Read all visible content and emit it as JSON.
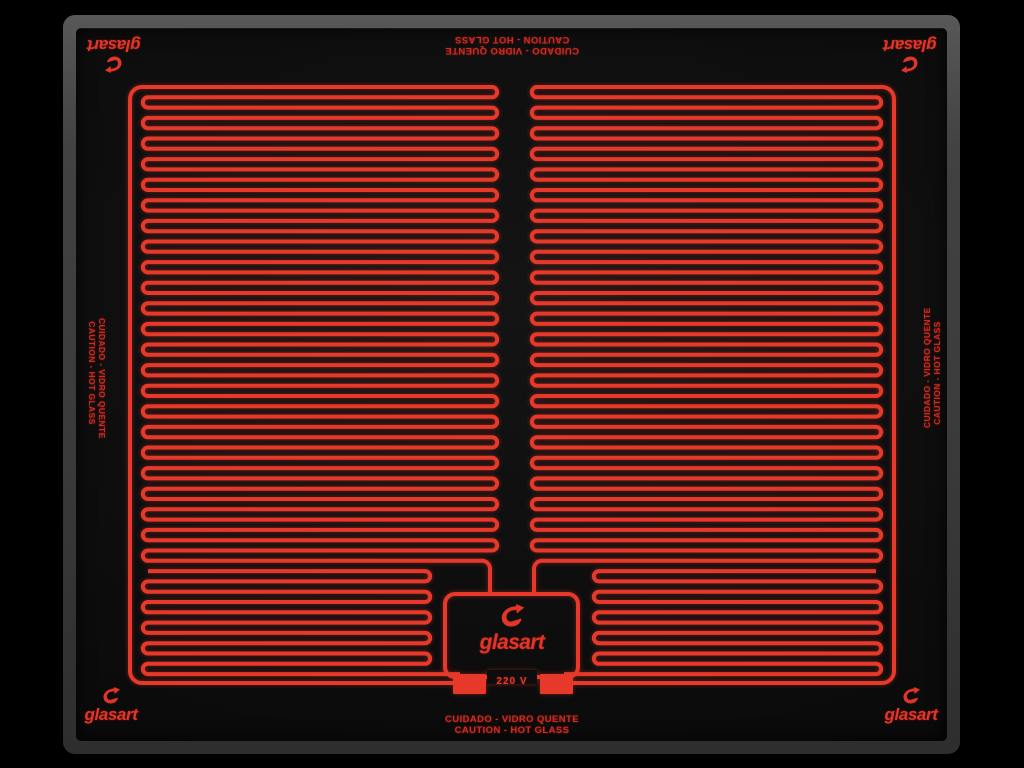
{
  "panel": {
    "brand_wordmark": "glasart",
    "voltage_label": "220 V",
    "warning": {
      "line1": "CUIDADO - VIDRO QUENTE",
      "line2": "CAUTION - HOT GLASS"
    },
    "colors": {
      "background": "#000000",
      "glass": "#0d0d0d",
      "frame": "#464646",
      "trace_red": "#e6392a",
      "warning_text_red": "#cf2b22",
      "brand_red": "#e23527"
    },
    "icons": {
      "brand_icon": "glasart-bird-icon"
    }
  }
}
